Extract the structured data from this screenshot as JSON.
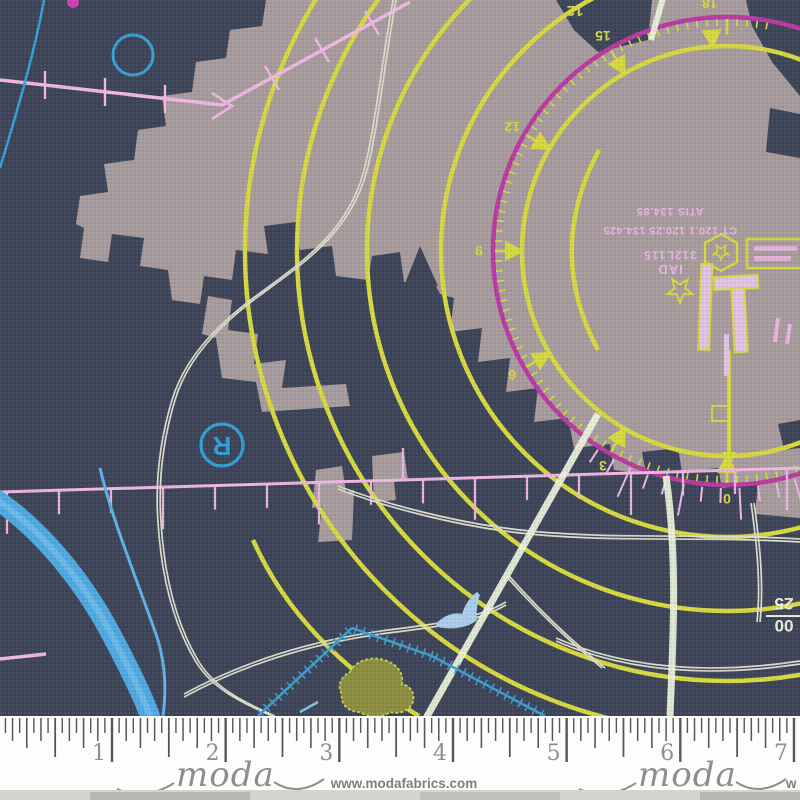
{
  "fabric_print": {
    "description": "aeronautical sectional chart print",
    "airport_info": {
      "line1": "IAD",
      "line2": "312L115",
      "line3": "CT 120.1 120.25 134.425",
      "line4": "ATIS 134.85"
    },
    "compass_labels": [
      {
        "text": "18",
        "deg": 356
      },
      {
        "text": "15",
        "deg": 330
      },
      {
        "text": "12",
        "deg": 300
      },
      {
        "text": "9",
        "deg": 270
      },
      {
        "text": "6",
        "deg": 240
      },
      {
        "text": "3",
        "deg": 210
      },
      {
        "text": "0",
        "deg": 180
      }
    ],
    "range_ring_label": "12",
    "altitude_label": {
      "top": "25",
      "bottom": "00"
    },
    "waypoint_letter": "R",
    "colors": {
      "background_navy": "#3e4558",
      "urban_gray": "#a79b9d",
      "chart_yellow": "#d6d840",
      "compass_magenta": "#b93aa2",
      "victor_pink": "#eeb7e3",
      "road_cream": "#dbdccb",
      "radial_cream": "#ebf2dc",
      "water_blue": "#4fa9e1",
      "cyan": "#35a2d4",
      "olive_green": "#8d8e41"
    }
  },
  "ruler": {
    "numbers": [
      "1",
      "2",
      "3",
      "4",
      "5",
      "6",
      "7"
    ]
  },
  "branding": {
    "logo_left": "moda",
    "url": "www.modafabrics.com",
    "logo_right": "moda",
    "url_partial": "w"
  }
}
